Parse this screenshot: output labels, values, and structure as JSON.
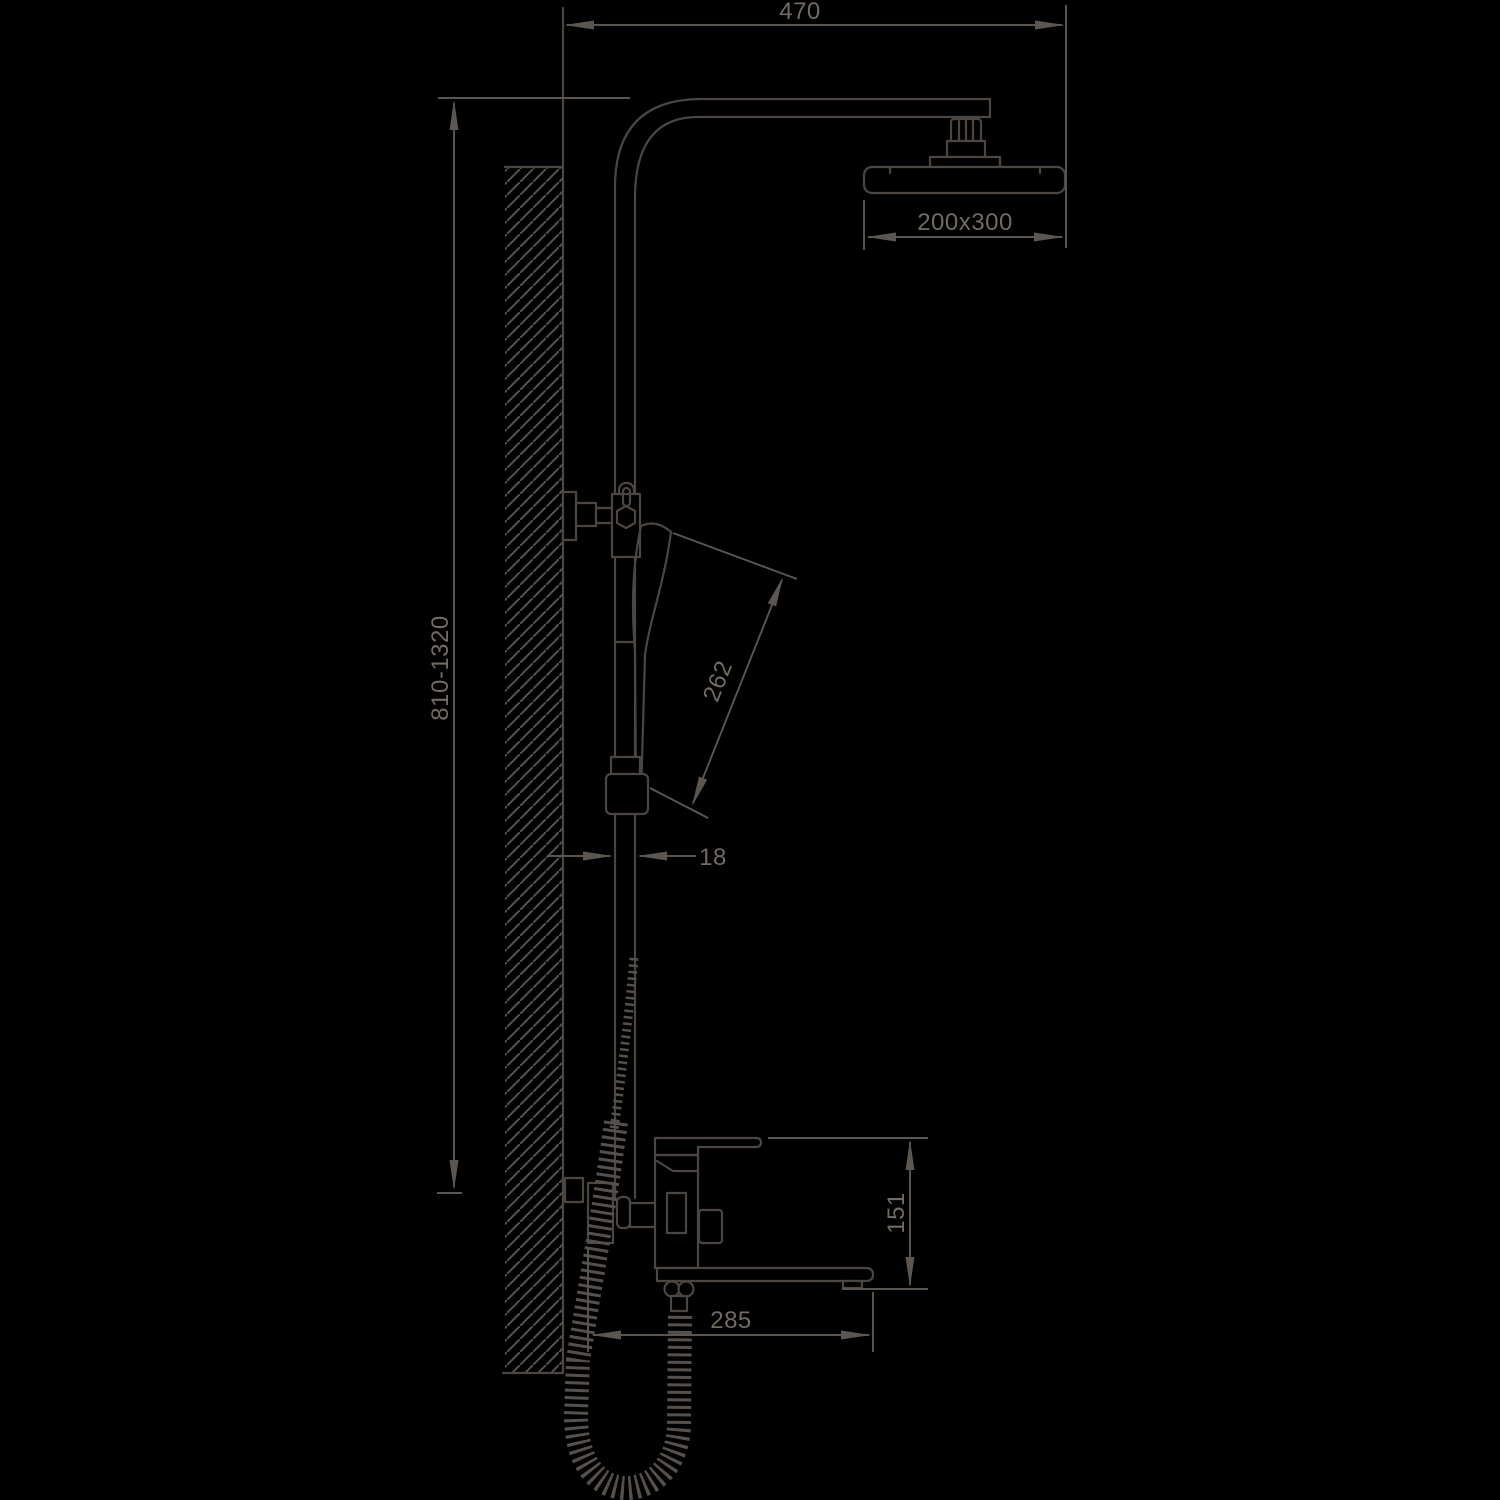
{
  "figure": {
    "type": "technical-drawing",
    "subject": "wall-mounted shower column with overhead rain shower, hand shower and bath mixer spout",
    "colors": {
      "background": "#000000",
      "outline": "#4b4641",
      "dimension_line": "#5b5651",
      "text": "#716b64",
      "hatch": "#575250"
    },
    "dimensions": {
      "arm_reach": "470",
      "head_size": "200x300",
      "column_height": "810-1320",
      "hand_shower_length": "262",
      "pipe_width": "18",
      "mixer_height": "151",
      "spout_reach": "285"
    }
  }
}
